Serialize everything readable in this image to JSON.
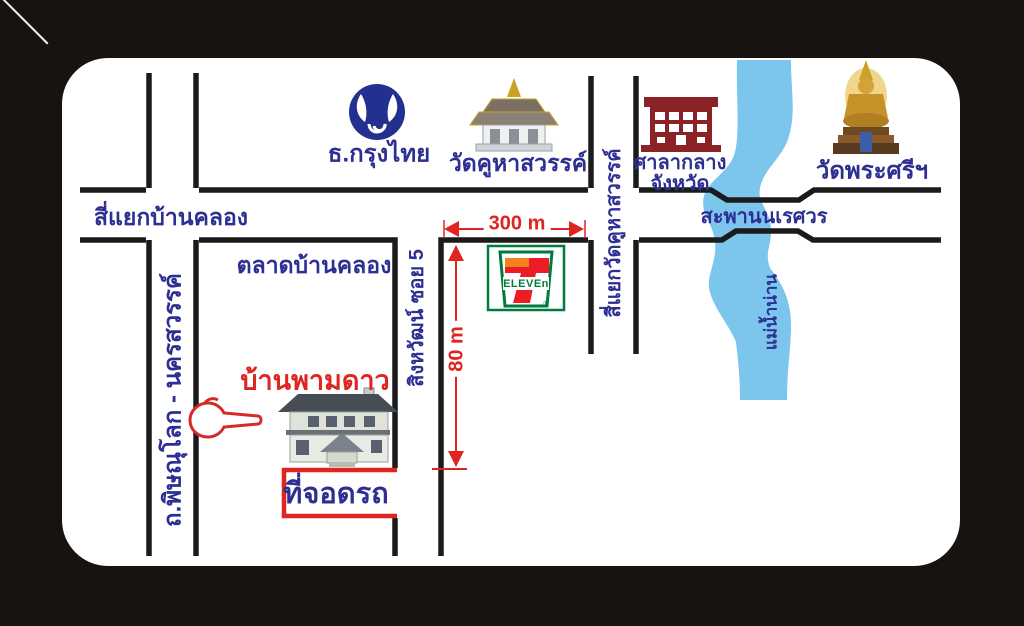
{
  "page": {
    "type": "location-map-card",
    "language": "th"
  },
  "landmarks": {
    "bank": "ธ.กรุงไทย",
    "temple_khuha_sawan": "วัดคูหาสวรรค์",
    "city_hall_line1": "ศาลากลาง",
    "city_hall_line2": "จังหวัด",
    "temple_phra_si": "วัดพระศรีฯ",
    "market": "ตลาดบ้านคลอง",
    "house": "บ้านพามดาว",
    "parking": "ที่จอดรถ"
  },
  "roads": {
    "intersection_ban_khlong": "สี่แยกบ้านคลอง",
    "intersection_wat_khuha": "สี่แยกวัดคูหาสวรรค์",
    "bridge_naresuan": "สะพานนเรศวร",
    "soi": "สิงหวัฒน์ ซอย 5",
    "main_road": "ถ.พิษณุโลก - นครสวรรค์",
    "river": "แม่น้ำน่าน"
  },
  "distances": {
    "d300": "300 m",
    "d80": "80 m"
  },
  "seven_eleven": {
    "digit": "7",
    "wordmark": "ELEVEn",
    "reg": "®"
  },
  "icons": {
    "bank_logo": "krungthai-bird-circle-logo",
    "temple": "thai-temple-icon",
    "city_hall": "government-building-icon",
    "buddha": "buddha-statue-icon",
    "seven_eleven": "7-eleven-logo",
    "house": "house-illustration",
    "hand": "red-hand-pointer-icon",
    "river": "river-band",
    "arrows": "red-distance-arrows"
  },
  "colors": {
    "background": "#171310",
    "card": "#ffffff",
    "road": "#1b1b1b",
    "label_navy": "#2d2f92",
    "accent_red": "#e02420",
    "river_blue": "#7cc6ee",
    "krungthai_blue": "#23308f",
    "city_hall_maroon": "#8b2226",
    "seven_green": "#007a3d",
    "seven_orange": "#f58220",
    "seven_red": "#ee1c25"
  }
}
